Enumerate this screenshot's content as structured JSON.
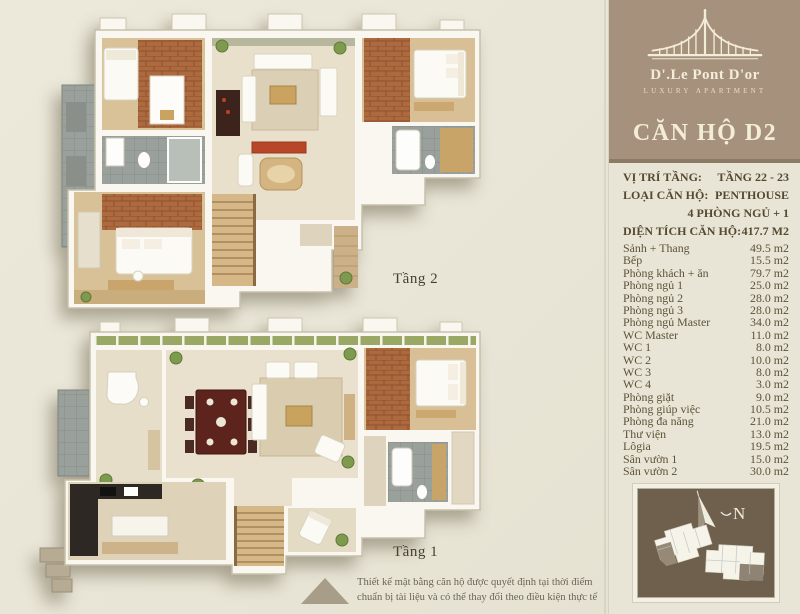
{
  "page": {
    "background": "#e9e5d6",
    "accent_brown": "#a5917c",
    "dark_brown": "#6e604d",
    "text_dark": "#55492f"
  },
  "plans": {
    "tang2_label": "Tầng 2",
    "tang1_label": "Tầng 1"
  },
  "disclaimer": {
    "line1": "Thiết kế mặt bằng căn hộ được quyết định tại thời điểm",
    "line2": "chuẩn bị tài liệu và có thể thay đổi theo điều kiện thực tế"
  },
  "sidebar": {
    "brand": {
      "name": "D'.Le Pont D'or",
      "tagline": "LUXURY APARTMENT"
    },
    "title": "CĂN HỘ D2",
    "info": [
      {
        "label": "VỊ TRÍ TẦNG:",
        "value": "TẦNG 22 - 23"
      },
      {
        "label": "LOẠI CĂN HỘ:",
        "value": "PENTHOUSE"
      },
      {
        "label": "",
        "value": "4 PHÒNG NGỦ + 1"
      },
      {
        "label": "DIỆN TÍCH CĂN HỘ:",
        "value": "417.7 M2"
      }
    ],
    "rooms": [
      {
        "name": "Sảnh + Thang",
        "area": "49.5 m2"
      },
      {
        "name": "Bếp",
        "area": "15.5 m2"
      },
      {
        "name": "Phòng khách + ăn",
        "area": "79.7 m2"
      },
      {
        "name": "Phòng ngủ 1",
        "area": "25.0 m2"
      },
      {
        "name": "Phòng ngủ 2",
        "area": "28.0 m2"
      },
      {
        "name": "Phòng ngủ 3",
        "area": "28.0 m2"
      },
      {
        "name": "Phòng ngủ Master",
        "area": "34.0 m2"
      },
      {
        "name": "WC Master",
        "area": "11.0 m2"
      },
      {
        "name": "WC 1",
        "area": "8.0 m2"
      },
      {
        "name": "WC 2",
        "area": "10.0 m2"
      },
      {
        "name": "WC 3",
        "area": "8.0 m2"
      },
      {
        "name": "WC 4",
        "area": "3.0 m2"
      },
      {
        "name": "Phòng giặt",
        "area": "9.0 m2"
      },
      {
        "name": "Phòng giúp việc",
        "area": "10.5 m2"
      },
      {
        "name": "Phòng đa năng",
        "area": "21.0 m2"
      },
      {
        "name": "Thư viện",
        "area": "13.0 m2"
      },
      {
        "name": "Lôgia",
        "area": "19.5 m2"
      },
      {
        "name": "Sân vườn 1",
        "area": "15.0 m2"
      },
      {
        "name": "Sân vườn 2",
        "area": "30.0 m2"
      }
    ],
    "compass": {
      "north": "N"
    }
  }
}
